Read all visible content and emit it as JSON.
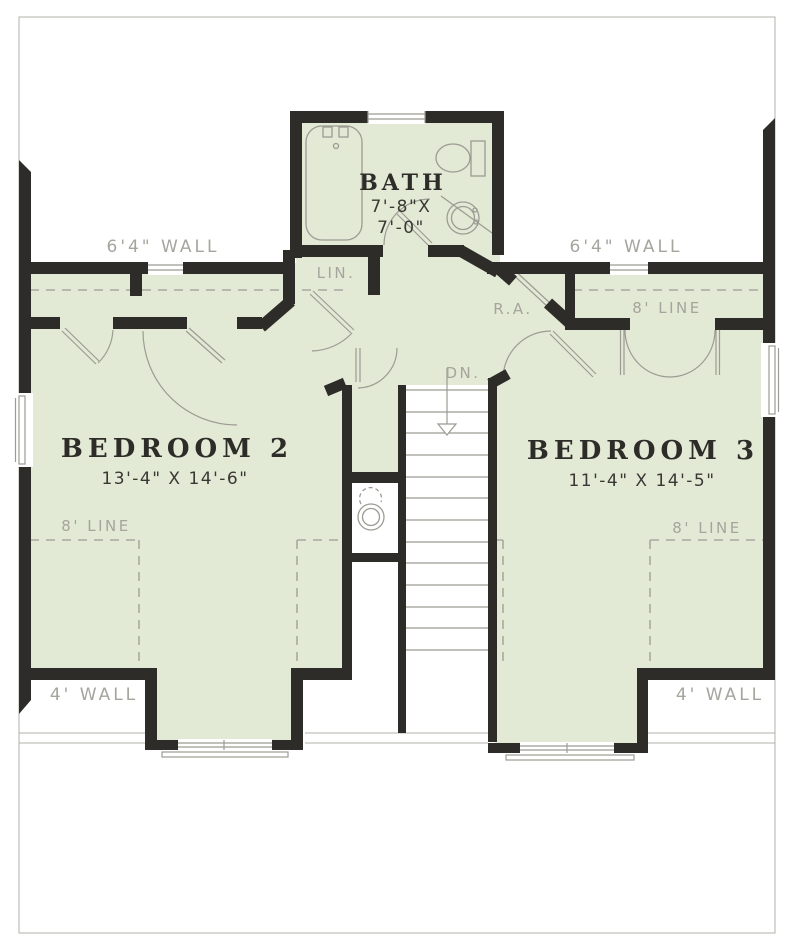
{
  "bath": {
    "name": "BATH",
    "dim1": "7'-8\"X",
    "dim2": "7'-0\""
  },
  "bedroom2": {
    "name": "BEDROOM 2",
    "dim": "13'-4\" X 14'-6\""
  },
  "bedroom3": {
    "name": "BEDROOM 3",
    "dim": "11'-4\" X 14'-5\""
  },
  "labels": {
    "lin": "LIN.",
    "ra": "R.A.",
    "dn": "DN.",
    "wall64_left": "6'4\" WALL",
    "wall64_right": "6'4\" WALL",
    "line8_top_right": "8' LINE",
    "line8_bottom_left": "8' LINE",
    "line8_bottom_right": "8' LINE",
    "wall4_left": "4' WALL",
    "wall4_right": "4' WALL"
  },
  "colors": {
    "floor_green": "#e2e9d4",
    "wall_black": "#2e2c28",
    "thin_gray": "#9c9c94",
    "label_gray": "#a5a59d"
  }
}
